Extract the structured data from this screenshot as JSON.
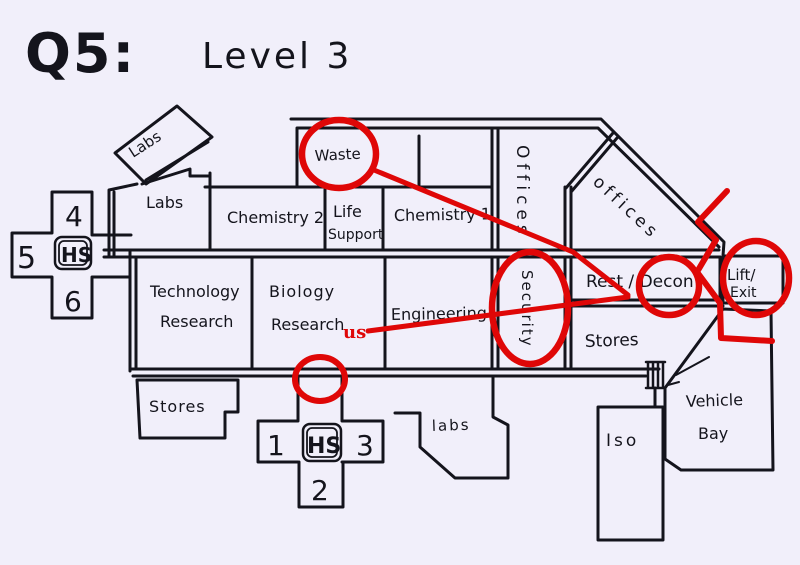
{
  "title": {
    "question": "Q5:",
    "level": "Level 3"
  },
  "rooms": {
    "labs_tilted": "Labs",
    "labs_west": "Labs",
    "chemistry_2": "Chemistry 2",
    "life_support_line1": "Life",
    "life_support_line2": "Support",
    "chemistry_1": "Chemistry 1",
    "waste": "Waste",
    "offices_corridor": "Offices",
    "offices_wing": "offices",
    "technology_research_line1": "Technology",
    "technology_research_line2": "Research",
    "biology_research_line1": "Biology",
    "biology_research_line2": "Research",
    "engineering": "Engineering",
    "security": "Security",
    "rest_decon": "Rest / Decon",
    "lift_exit_line1": "Lift/",
    "lift_exit_line2": "Exit",
    "stores_east": "Stores",
    "stores_south": "Stores",
    "labs_south": "labs",
    "iso": "Iso",
    "vehicle_bay_line1": "Vehicle",
    "vehicle_bay_line2": "Bay"
  },
  "airlock_left": {
    "top": "4",
    "left": "5",
    "center": "HS",
    "bottom": "6"
  },
  "airlock_bottom": {
    "left": "1",
    "center": "HS",
    "right": "3",
    "bottom": "2"
  },
  "annotations": {
    "us_marker": "us"
  },
  "colors": {
    "background": "#f1effa",
    "ink": "#14141c",
    "highlight": "#df0707"
  }
}
